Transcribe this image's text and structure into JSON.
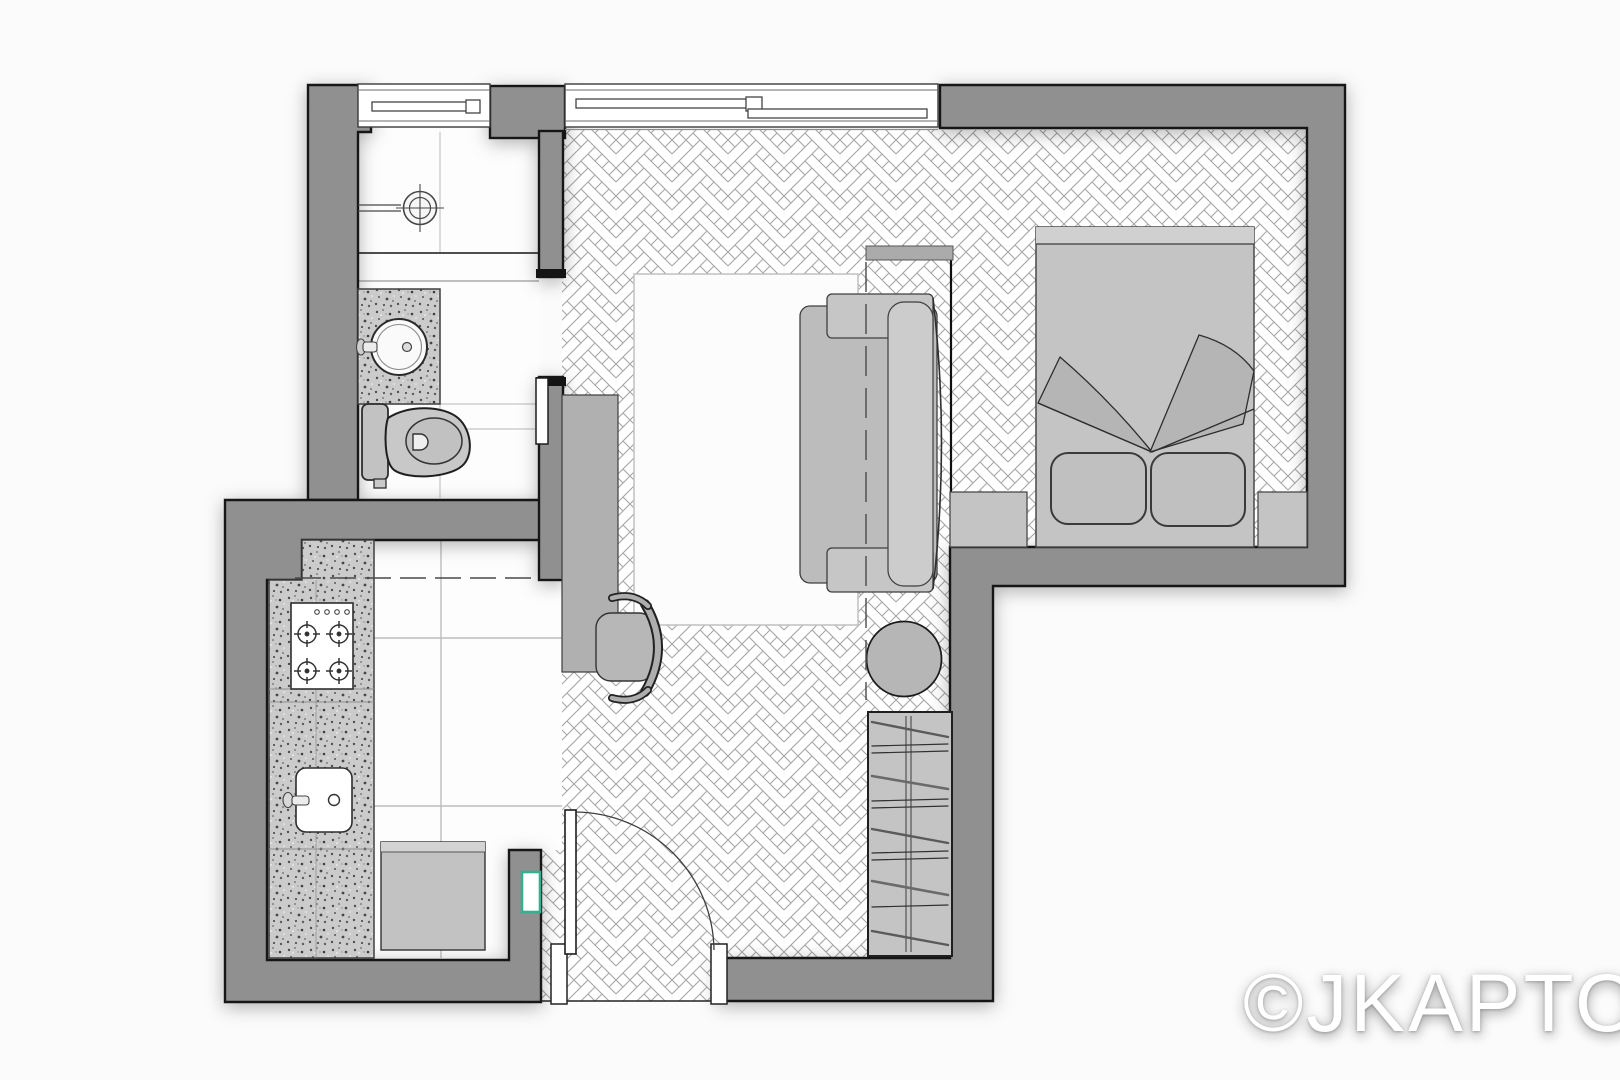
{
  "page": {
    "background": "#fbfbfb"
  },
  "watermark": {
    "text": "©JKAPTO"
  },
  "colors": {
    "page_bg": "#fbfbfb",
    "wall": "#909090",
    "wall_line": "#161616",
    "furn": "#bcbcbc",
    "furn_light": "#cccccc",
    "furn_line": "#3c3c3c",
    "floor_line": "#9f9f9f",
    "tile_line": "#c6c6c6",
    "rug": "#fcfcfc",
    "counter_base": "#cbcbcb",
    "accent_green": "#35b08e"
  },
  "rooms": [
    {
      "id": "bathroom"
    },
    {
      "id": "kitchen"
    },
    {
      "id": "living-room"
    },
    {
      "id": "bedroom"
    },
    {
      "id": "entry"
    }
  ],
  "furniture": [
    "shower-head",
    "vanity-basin",
    "toilet",
    "pocket-door",
    "cooktop",
    "kitchen-sink",
    "kitchen-table",
    "upper-cabinets-dashed",
    "desk",
    "desk-chair",
    "area-rug",
    "sofa",
    "wall-shelf",
    "side-table",
    "wardrobe",
    "entry-door",
    "double-bed",
    "pillow",
    "nightstand"
  ]
}
